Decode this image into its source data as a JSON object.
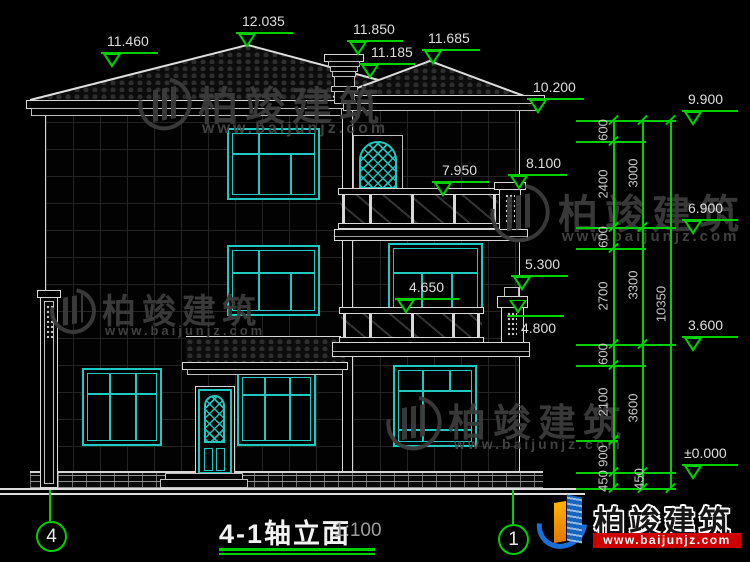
{
  "drawing": {
    "title": "4-1轴立面",
    "scale": "1:100",
    "axis_left": "4",
    "axis_right": "1",
    "elevation_markers": {
      "v11460": "11.460",
      "v12035": "12.035",
      "v11850": "11.850",
      "v11185": "11.185",
      "v11685": "11.685",
      "v10200": "10.200",
      "v9900": "9.900",
      "v8100": "8.100",
      "v7950": "7.950",
      "v6900": "6.900",
      "v5300": "5.300",
      "v4650": "4.650",
      "v4800": "4.800",
      "v3600": "3.600",
      "v0000": "±0.000"
    },
    "dimensions": {
      "chain1": [
        "600",
        "2400",
        "600",
        "2700",
        "600",
        "2100",
        "900",
        "450"
      ],
      "chain2": [
        "3000",
        "3300",
        "3600",
        "450"
      ],
      "total": "10350"
    }
  },
  "watermark": {
    "name": "柏竣建筑",
    "url": "www.baijunjz.com"
  },
  "footer": {
    "name": "柏竣建筑",
    "url": "www.baijunjz.com"
  }
}
